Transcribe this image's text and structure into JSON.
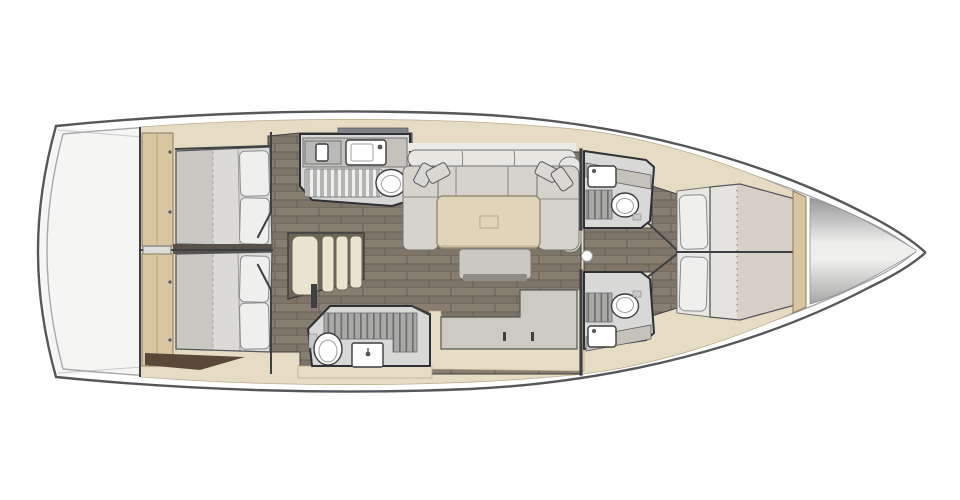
{
  "scene": {
    "type": "yacht-interior-floorplan",
    "orientation": "bow-right",
    "background": "#ffffff"
  },
  "regions": {
    "stern": "stern-lazarette",
    "aft_cabin_top": "aft-double-berth-cabin",
    "aft_cabin_bottom": "aft-double-berth-cabin",
    "head_top": "wet-head-with-shower-and-toilet",
    "head_bottom": "wet-head-with-shower-and-toilet",
    "companionway": "companionway-steps",
    "salon": "l-shaped-settee-with-saloon-table",
    "galley": "galley-counter",
    "head_fwd_top": "forward-en-suite-head",
    "head_fwd_bottom": "forward-en-suite-head",
    "forward_cabin": "forward-double-berth",
    "bow": "bow-anchor-locker"
  },
  "colors": {
    "hull_fill": "#ffffff",
    "hull_stroke": "#55575a",
    "deck_line": "#a6a8aa",
    "stern_fill": "#f5f5f3",
    "cabinetry_beige": "#e6dcc4",
    "cabinetry_edge": "#b9ab8c",
    "wardrobe_tan": "#d9c5a0",
    "wardrobe_edge": "#8a7a5f",
    "wood_brown": "#5a4938",
    "floor_dark": "#7e7568",
    "floor_dark2": "#877e71",
    "floor_line": "#665e53",
    "wall_dark": "#3e3f42",
    "mattress": "#dbdad6",
    "mattress_light": "#e4e3df",
    "mattress_edge": "#55565a",
    "duvet": "#c9c8c3",
    "blanket": "#d6d1c8",
    "pillow": "#efefed",
    "pillow_edge": "#8a8c8e",
    "sofa_seat": "#d5d3cc",
    "sofa_back": "#e8e6e0",
    "sofa_edge": "#707274",
    "cushion": "#dad8d2",
    "table_top": "#e0d5ba",
    "table_edge": "#978c70",
    "bench": "#cbc8c1",
    "bench_base": "#8f8c85",
    "head_floor": "#d8d8d6",
    "head_wall": "#2f3033",
    "counter_gray": "#c5c1bb",
    "grate_base_light": "#b4b4b2",
    "grate_slat_light": "#efefed",
    "grate_base_dark": "#a9a9a7",
    "grate_slat_dark": "#6e6e6c",
    "fixture_white": "#ffffff",
    "fixture_edge": "#3c3d40",
    "galley_top": "#cdc9c3",
    "step_cream": "#eae3d0",
    "step_frame": "#6b6257",
    "bow_dark": "#97979a",
    "bow_light": "#f1f0ee",
    "ball_white": "#ffffff"
  }
}
